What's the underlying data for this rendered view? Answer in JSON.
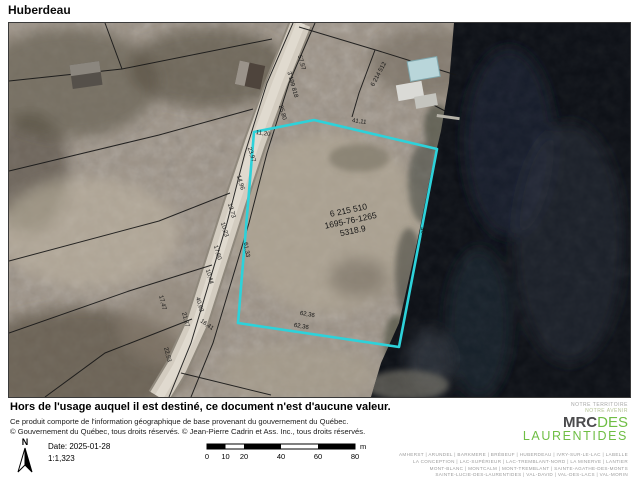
{
  "title": "Huberdeau",
  "map": {
    "highlight_color": "#2dd2da",
    "parcel_labels": [
      "6 215 510",
      "1695-76-1265",
      "5318.9"
    ],
    "adjacent_lot": "6 214 512",
    "road_lot": "3 199 818",
    "dimension_labels": [
      "57,57",
      "25,80",
      "11,20",
      "23,97",
      "41,11",
      "14,96",
      "13,73",
      "10,23",
      "17,60",
      "10,44",
      "61,33",
      "40,63",
      "16,41",
      "21,37",
      "17,47",
      "22,53",
      "62,36",
      "62,36",
      "40,77"
    ]
  },
  "footer": {
    "disclaimer": "Hors de l'usage auquel il est destiné, ce document n'est d'aucune valeur.",
    "credit_line1": "Ce produit comporte de l'information géographique de base provenant du gouvernement du Québec.",
    "credit_line2": "© Gouvernement du Québec, tous droits réservés. © Jean-Pierre Cadrin et Ass. Inc., tous droits réservés.",
    "north_label": "N",
    "date": "Date: 2025-01-28",
    "scale": "1:1,323",
    "scalebar": {
      "ticks": [
        "0",
        "10",
        "20",
        "40",
        "60",
        "80"
      ],
      "unit": "m"
    }
  },
  "logo": {
    "tagline_line1": "NOTRE TERRITOIRE",
    "tagline_line2": "NOTRE AVENIR",
    "mrc": "MRC",
    "des": "DES",
    "name": "LAURENTIDES",
    "green": "#6fbe44",
    "municipalities": [
      "AMHERST | ARUNDEL | BARKMERE | BRÉBEUF | HUBERDEAU | IVRY-SUR-LE-LAC | LABELLE",
      "LA CONCEPTION | LAC-SUPÉRIEUR | LAC-TREMBLANT-NORD | LA MINERVE | LANTIER",
      "MONT-BLANC | MONTCALM | MONT-TREMBLANT | SAINTE-AGATHE-DES-MONTS",
      "SAINTE-LUCIE-DES-LAURENTIDES | VAL-DAVID | VAL-DES-LACS | VAL-MORIN"
    ]
  }
}
